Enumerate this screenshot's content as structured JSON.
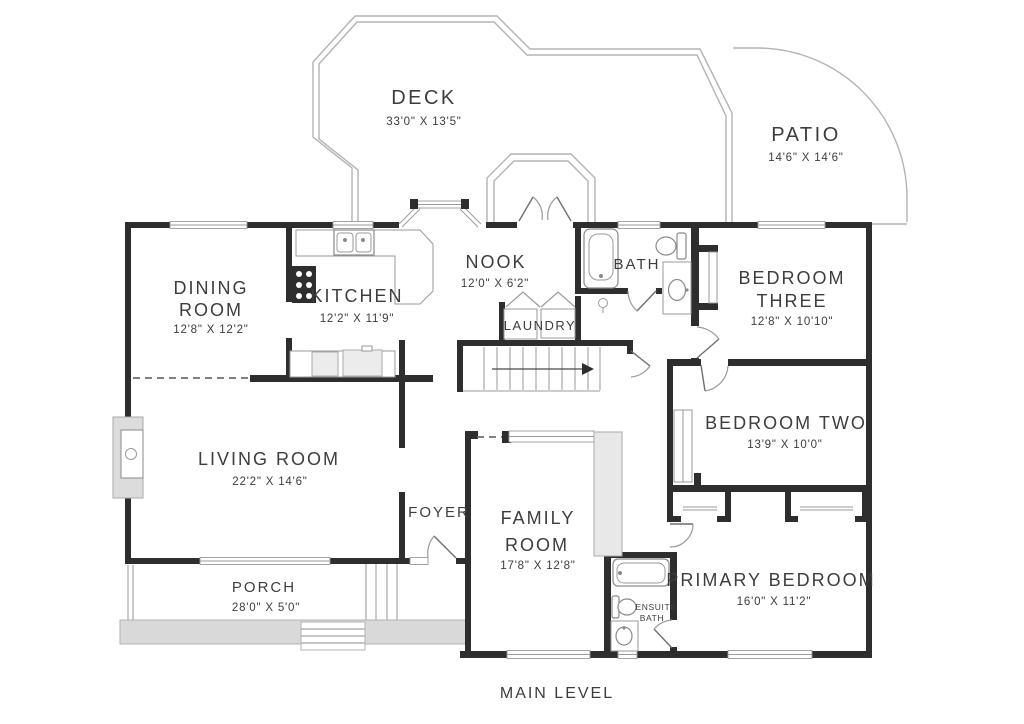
{
  "title": "MAIN LEVEL",
  "rooms": {
    "deck": {
      "name": "DECK",
      "dims": "33'0\" X 13'5\""
    },
    "patio": {
      "name": "PATIO",
      "dims": "14'6\" X 14'6\""
    },
    "dining_room": {
      "name_line1": "DINING",
      "name_line2": "ROOM",
      "dims": "12'8\" X 12'2\""
    },
    "kitchen": {
      "name": "KITCHEN",
      "dims": "12'2\" X 11'9\""
    },
    "nook": {
      "name": "NOOK",
      "dims": "12'0\" X 6'2\""
    },
    "bath": {
      "name": "BATH"
    },
    "laundry": {
      "name": "LAUNDRY"
    },
    "bedroom_three": {
      "name_line1": "BEDROOM",
      "name_line2": "THREE",
      "dims": "12'8\" X 10'10\""
    },
    "bedroom_two": {
      "name": "BEDROOM TWO",
      "dims": "13'9\" X 10'0\""
    },
    "living_room": {
      "name": "LIVING ROOM",
      "dims": "22'2\" X 14'6\""
    },
    "foyer": {
      "name": "FOYER"
    },
    "family_room": {
      "name_line1": "FAMILY",
      "name_line2": "ROOM",
      "dims": "17'8\" X 12'8\""
    },
    "ensuite": {
      "name_line1": "ENSUITE",
      "name_line2": "BATH"
    },
    "primary_bedroom": {
      "name": "PRIMARY BEDROOM",
      "dims": "16'0\" X 11'2\""
    },
    "porch": {
      "name": "PORCH",
      "dims": "28'0\" X 5'0\""
    }
  },
  "colors": {
    "wall": "#2e2e2e",
    "outline": "#b3b3b3",
    "slab": "#d9d9d9",
    "text": "#3d3d3d"
  }
}
